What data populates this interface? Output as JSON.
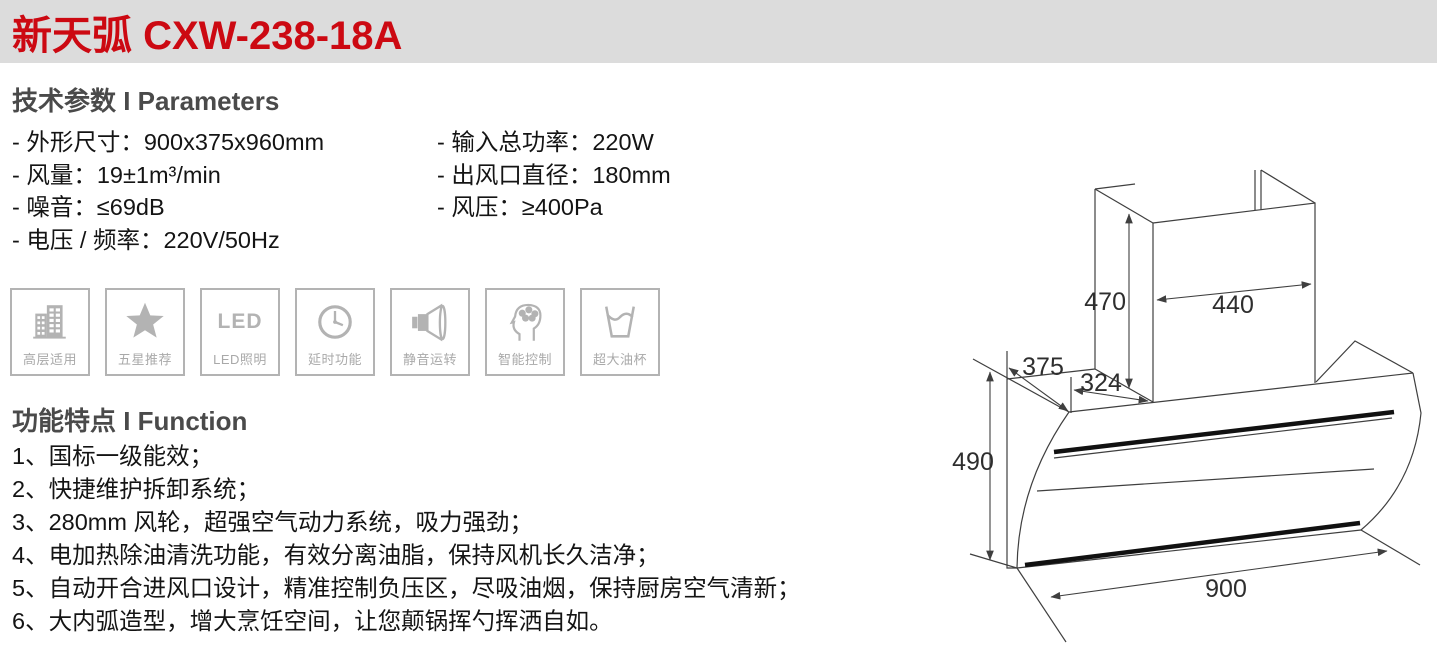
{
  "header": {
    "title": "新天弧 CXW-238-18A"
  },
  "parameters": {
    "heading": "技术参数 I Parameters",
    "left": [
      "- 外形尺寸：900x375x960mm",
      "- 风量：19±1m³/min",
      "- 噪音：≤69dB",
      "- 电压 / 频率：220V/50Hz"
    ],
    "right": [
      "- 输入总功率：220W",
      "- 出风口直径：180mm",
      "- 风压：≥400Pa"
    ]
  },
  "badges": {
    "items": [
      {
        "icon": "highrise-building-icon",
        "label": "高层适用"
      },
      {
        "icon": "five-star-icon",
        "label": "五星推荐"
      },
      {
        "icon": "led-icon",
        "label": "LED照明",
        "icon_text": "LED"
      },
      {
        "icon": "clock-icon",
        "label": "延时功能"
      },
      {
        "icon": "speaker-icon",
        "label": "静音运转"
      },
      {
        "icon": "smart-brain-icon",
        "label": "智能控制"
      },
      {
        "icon": "oil-cup-icon",
        "label": "超大油杯"
      }
    ]
  },
  "functions": {
    "heading": "功能特点 I Function",
    "items": [
      "1、国标一级能效；",
      "2、快捷维护拆卸系统；",
      "3、280mm 风轮，超强空气动力系统，吸力强劲；",
      "4、电加热除油清洗功能，有效分离油脂，保持风机长久洁净；",
      "5、自动开合进风口设计，精准控制负压区，尽吸油烟，保持厨房空气清新；",
      "6、大内弧造型，增大烹饪空间，让您颠锅挥勺挥洒自如。"
    ]
  },
  "diagram": {
    "dimensions": {
      "chimney_height": "470",
      "chimney_width": "440",
      "top_depth": "375",
      "top_inner_depth": "324",
      "body_height": "490",
      "body_width": "900"
    }
  },
  "colors": {
    "brand_red": "#cc0912",
    "header_gray": "#dcdcdc",
    "heading_gray": "#4a4a4a",
    "icon_gray": "#b3b3b3",
    "line_gray": "#3f3f3f"
  }
}
